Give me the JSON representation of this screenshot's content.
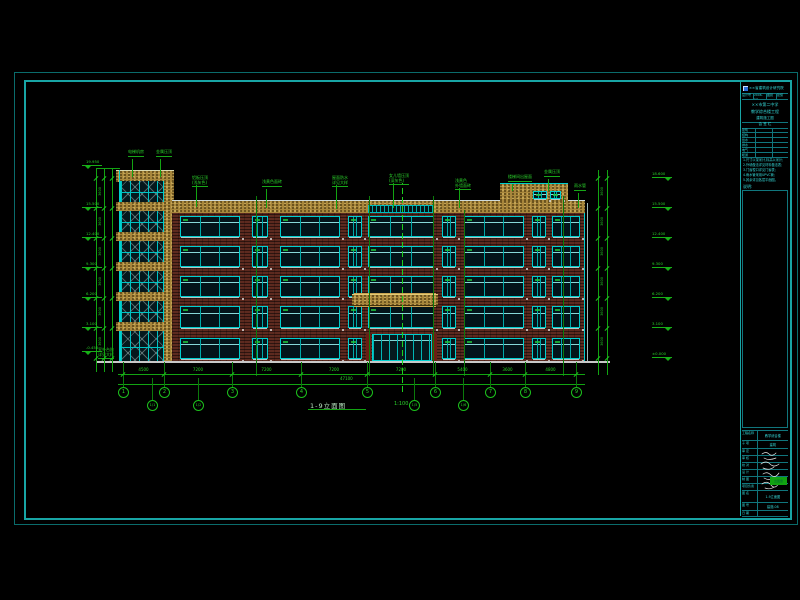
{
  "drawing": {
    "title": "1-9立面图",
    "scale": "1:100",
    "floor_dim": "3600",
    "total_dim": "47100"
  },
  "colors": {
    "background": "#000000",
    "frame_outer": "#0a6c6c",
    "frame_inner": "#18a5a5",
    "cad_cyan": "#00d2d2",
    "cad_green": "#18c018",
    "brick": "#5d2a1f",
    "stone_gold": "#b2903f",
    "ground_white": "#c8c8c8",
    "logo_blue": "#2b6bd6",
    "stamp_green": "#11a211"
  },
  "grid": {
    "bubbles": [
      {
        "x": 123,
        "label": "1"
      },
      {
        "x": 164,
        "label": "2"
      },
      {
        "x": 232,
        "label": "3"
      },
      {
        "x": 301,
        "label": "4"
      },
      {
        "x": 367,
        "label": "5"
      },
      {
        "x": 435,
        "label": "6"
      },
      {
        "x": 490,
        "label": "7"
      },
      {
        "x": 525,
        "label": "8"
      },
      {
        "x": 576,
        "label": "9"
      }
    ],
    "offset_bubbles": [
      {
        "x": 152,
        "label": "1/1"
      },
      {
        "x": 198,
        "label": "1/2"
      },
      {
        "x": 414,
        "label": "1/5"
      },
      {
        "x": 463,
        "label": "1/6"
      }
    ],
    "segments": [
      "4500",
      "7200",
      "7200",
      "7200",
      "7200",
      "5400",
      "3600",
      "4800"
    ]
  },
  "levels": {
    "left": [
      {
        "y": 166,
        "v": "19.950"
      },
      {
        "y": 208,
        "v": "15.500"
      },
      {
        "y": 238,
        "v": "12.400"
      },
      {
        "y": 268,
        "v": "9.300"
      },
      {
        "y": 298,
        "v": "6.200"
      },
      {
        "y": 328,
        "v": "3.100"
      },
      {
        "y": 352,
        "v": "-0.450"
      }
    ],
    "right": [
      {
        "y": 178,
        "v": "18.600"
      },
      {
        "y": 208,
        "v": "15.500"
      },
      {
        "y": 238,
        "v": "12.400"
      },
      {
        "y": 268,
        "v": "9.300"
      },
      {
        "y": 298,
        "v": "6.200"
      },
      {
        "y": 328,
        "v": "3.100"
      },
      {
        "y": 358,
        "v": "±0.000"
      }
    ]
  },
  "annotations": {
    "roof_labels": [
      {
        "x": 192,
        "y": 176,
        "l1": "铝板压顶",
        "l2": "(浅灰色)",
        "drop": 22
      },
      {
        "x": 262,
        "y": 180,
        "l1": "",
        "l2": "浅黄色面砖",
        "drop": 19
      },
      {
        "x": 332,
        "y": 176,
        "l1": "屋面防水",
        "l2": "详见大样",
        "drop": 24
      },
      {
        "x": 389,
        "y": 174,
        "l1": "女儿墙压顶",
        "l2": "(深灰色)",
        "drop": 25
      },
      {
        "x": 455,
        "y": 179,
        "l1": "浅黄色",
        "l2": "外墙面砖",
        "drop": 20
      },
      {
        "x": 508,
        "y": 175,
        "l1": "",
        "l2": "楼梯间出屋面",
        "drop": 7
      },
      {
        "x": 544,
        "y": 170,
        "l1": "",
        "l2": "金属压顶",
        "drop": 12
      },
      {
        "x": 574,
        "y": 184,
        "l1": "",
        "l2": "雨水管",
        "drop": 15
      }
    ],
    "tower_labels": [
      {
        "x": 128,
        "y": 150,
        "l2": "电梯机房",
        "drop": 18
      },
      {
        "x": 156,
        "y": 150,
        "l2": "金属压顶",
        "drop": 18
      }
    ],
    "base_label": {
      "l1": "室外台阶",
      "l2": "详见大样"
    }
  },
  "titleblock": {
    "company": "××省建筑设计研究院",
    "fields": [
      "设计号",
      "2006-12",
      "图别",
      "建施"
    ],
    "project": [
      "××市第二中学",
      "教学综合楼工程",
      "建筑施工图"
    ],
    "sign_header": "会  签  栏",
    "sign_rows": [
      "建筑",
      "结构",
      "给水",
      "排水",
      "电气",
      "暖通"
    ],
    "notes_label": "说明:",
    "notes": [
      "1.尺寸以毫米计,标高以米计;",
      "2.外墙做法详见材料做法表;",
      "3.门窗樘口详见门窗表;",
      "4.雨水管采用UPVC管;",
      "5.其余详见各层平面图。"
    ],
    "bottom_rows": [
      {
        "label": "工程名称",
        "value": "教学综合楼",
        "h": 10
      },
      {
        "label": "子 项",
        "value": "建筑",
        "h": 8
      },
      {
        "label": "审 定",
        "value": "",
        "h": 7
      },
      {
        "label": "审 核",
        "value": "",
        "h": 7
      },
      {
        "label": "校 对",
        "value": "",
        "h": 7
      },
      {
        "label": "设 计",
        "value": "",
        "h": 7
      },
      {
        "label": "制 图",
        "value": "",
        "h": 7
      },
      {
        "label": "项目负责",
        "value": "",
        "h": 7
      },
      {
        "label": "图 名",
        "value": "1-9立面图",
        "h": 12
      },
      {
        "label": "图 号",
        "value": "建施-08",
        "h": 8
      },
      {
        "label": "日 期",
        "value": "",
        "h": 6
      }
    ],
    "stamp": "出图章"
  }
}
